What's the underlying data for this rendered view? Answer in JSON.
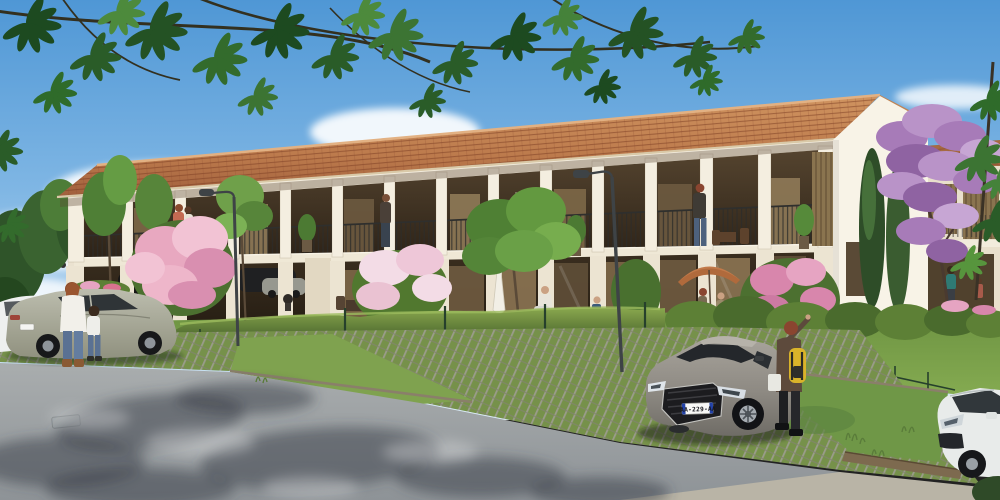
{
  "scene": {
    "description": "Sunny 3D architectural rendering of a long two-storey cream residence with terracotta tile roof and open loggia balconies, private gardens behind a hedge and dark metal fence, grass-paver parking with a gray sedan, family by a sage sedan at left, overhanging tree branches at top, purple blossom tree and second building at right.",
    "license_plate": "AA-229-AA",
    "palette": {
      "sky_top": "#5b9ed8",
      "sky_horizon": "#dcecf7",
      "roof_light": "#cd8f5c",
      "roof_dark": "#9c5f3a",
      "facade": "#f3edde",
      "loggia_opening": "#3f3223",
      "hedge": "#5d8036",
      "lawn": "#7aa04b",
      "paver_green": "#76914a",
      "asphalt": "#9fa4a6",
      "gray_car": "#938f88",
      "sage_car": "#a9aa9b",
      "plate_band_blue": "#2242a8",
      "purple_tree": "#a77bb8",
      "leaf_green": "#2a5c28",
      "parasol_orange": "#c27a4a"
    }
  }
}
